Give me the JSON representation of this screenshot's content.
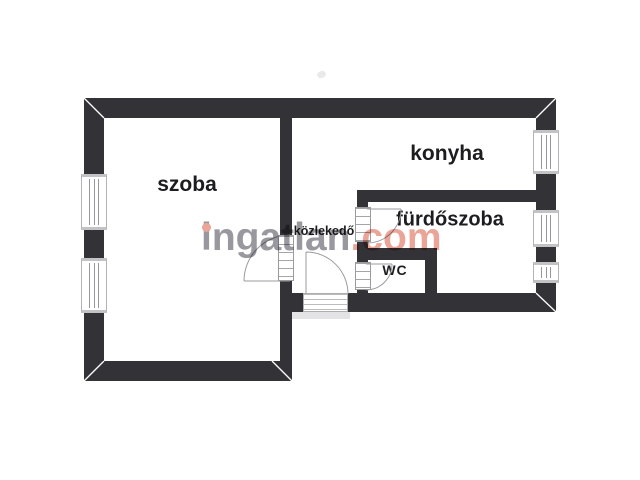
{
  "floorplan": {
    "type": "apartment-floor-plan",
    "wall_color": "#333237",
    "background_color": "#ffffff",
    "rooms": [
      {
        "id": "szoba",
        "label": "szoba"
      },
      {
        "id": "konyha",
        "label": "konyha"
      },
      {
        "id": "furdoszoba",
        "label": "fürdőszoba"
      },
      {
        "id": "wc",
        "label": "WC"
      },
      {
        "id": "kozlekedo",
        "label": "közlekedő"
      }
    ],
    "symbols": {
      "windows": 5,
      "door_swings": 4,
      "entry_threshold": 1
    }
  },
  "watermark": {
    "brand_gray": "ingatlan",
    "brand_accent": ".com",
    "gray_color": "#98989e",
    "accent_color": "#eaa498"
  }
}
